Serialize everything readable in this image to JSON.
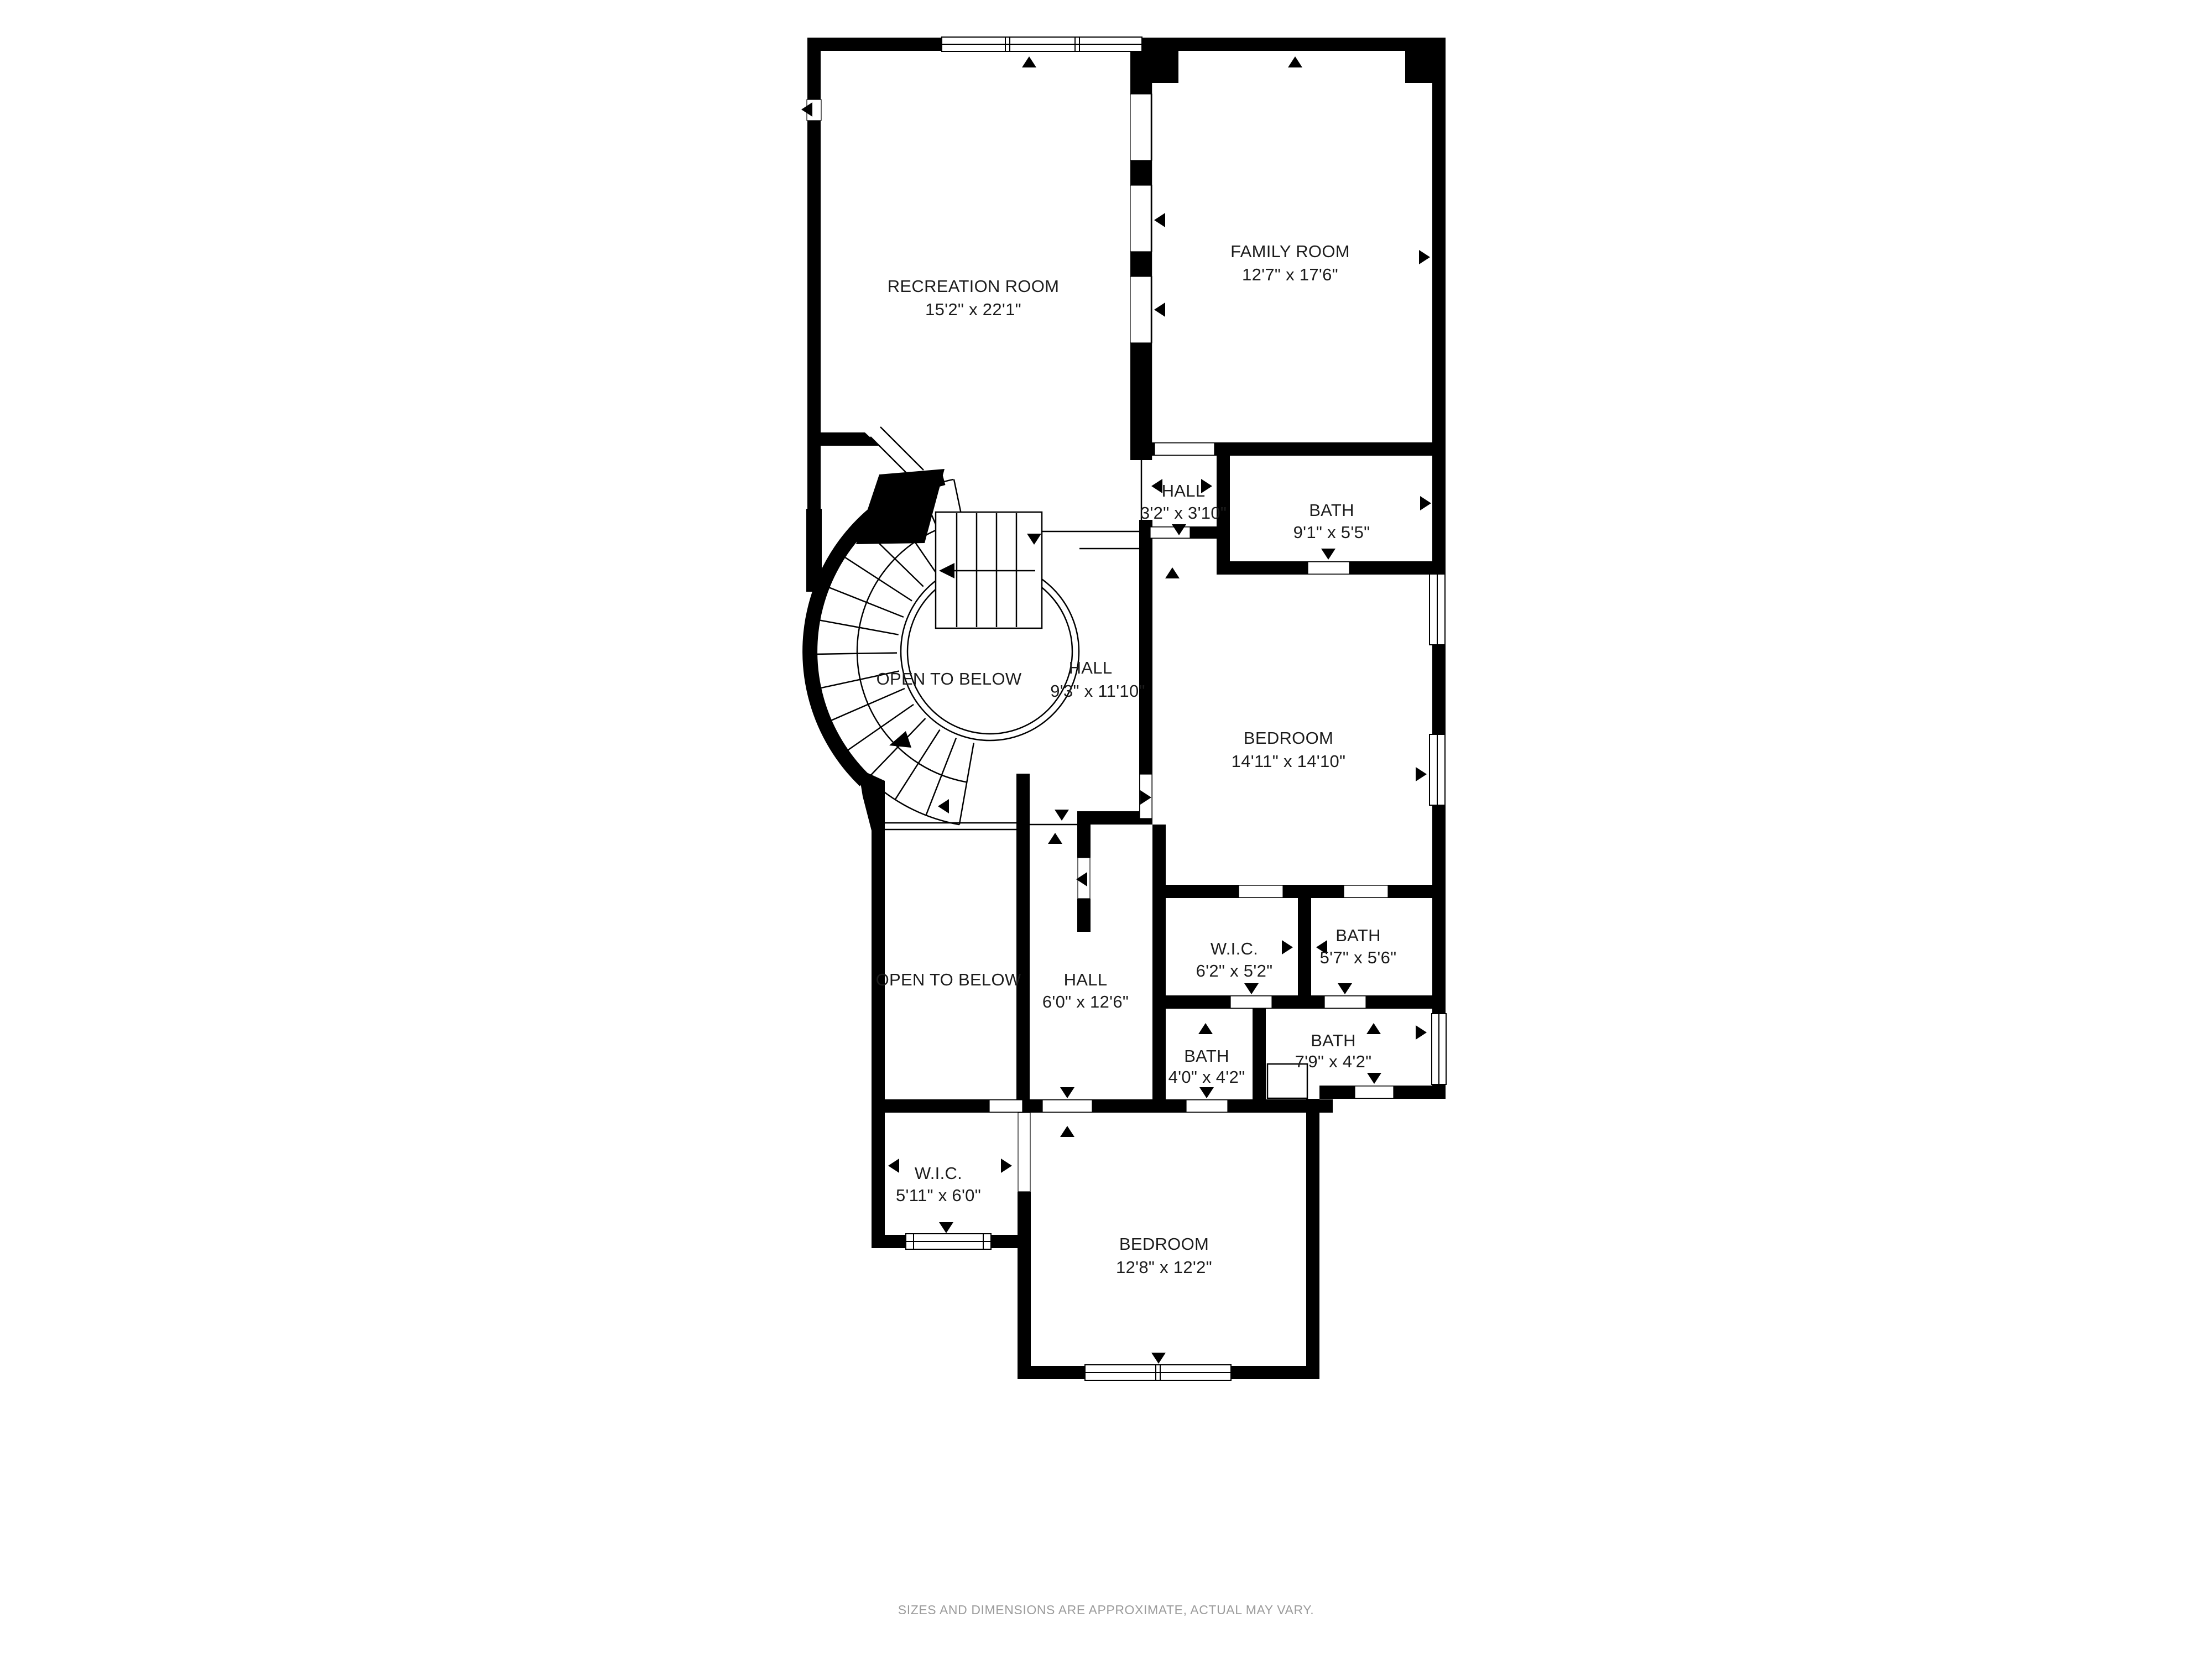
{
  "plan": {
    "footer_disclaimer": "SIZES AND DIMENSIONS ARE APPROXIMATE, ACTUAL MAY VARY.",
    "colors": {
      "walls": "#000000",
      "floor": "#ffffff",
      "label_text": "#1c1c1c",
      "disclaimer_text": "#9b9b9b"
    },
    "rooms": [
      {
        "id": "recreation-room",
        "name": "RECREATION ROOM",
        "dims": "15'2\" x 22'1\""
      },
      {
        "id": "family-room",
        "name": "FAMILY ROOM",
        "dims": "12'7\" x 17'6\""
      },
      {
        "id": "hall-upper",
        "name": "HALL",
        "dims": "3'2\" x 3'10\""
      },
      {
        "id": "bath-upper",
        "name": "BATH",
        "dims": "9'1\" x 5'5\""
      },
      {
        "id": "open-to-below-stairs",
        "name": "OPEN TO BELOW",
        "dims": ""
      },
      {
        "id": "hall-landing",
        "name": "HALL",
        "dims": "9'3\" x 11'10\""
      },
      {
        "id": "bedroom-primary",
        "name": "BEDROOM",
        "dims": "14'11\" x 14'10\""
      },
      {
        "id": "open-to-below-lower",
        "name": "OPEN TO BELOW",
        "dims": ""
      },
      {
        "id": "hall-lower",
        "name": "HALL",
        "dims": "6'0\" x 12'6\""
      },
      {
        "id": "wic-upper",
        "name": "W.I.C.",
        "dims": "6'2\" x 5'2\""
      },
      {
        "id": "bath-5-7",
        "name": "BATH",
        "dims": "5'7\" x 5'6\""
      },
      {
        "id": "bath-4-0",
        "name": "BATH",
        "dims": "4'0\" x 4'2\""
      },
      {
        "id": "bath-7-9",
        "name": "BATH",
        "dims": "7'9\" x 4'2\""
      },
      {
        "id": "wic-lower",
        "name": "W.I.C.",
        "dims": "5'11\" x 6'0\""
      },
      {
        "id": "bedroom-second",
        "name": "BEDROOM",
        "dims": "12'8\" x 12'2\""
      }
    ]
  }
}
